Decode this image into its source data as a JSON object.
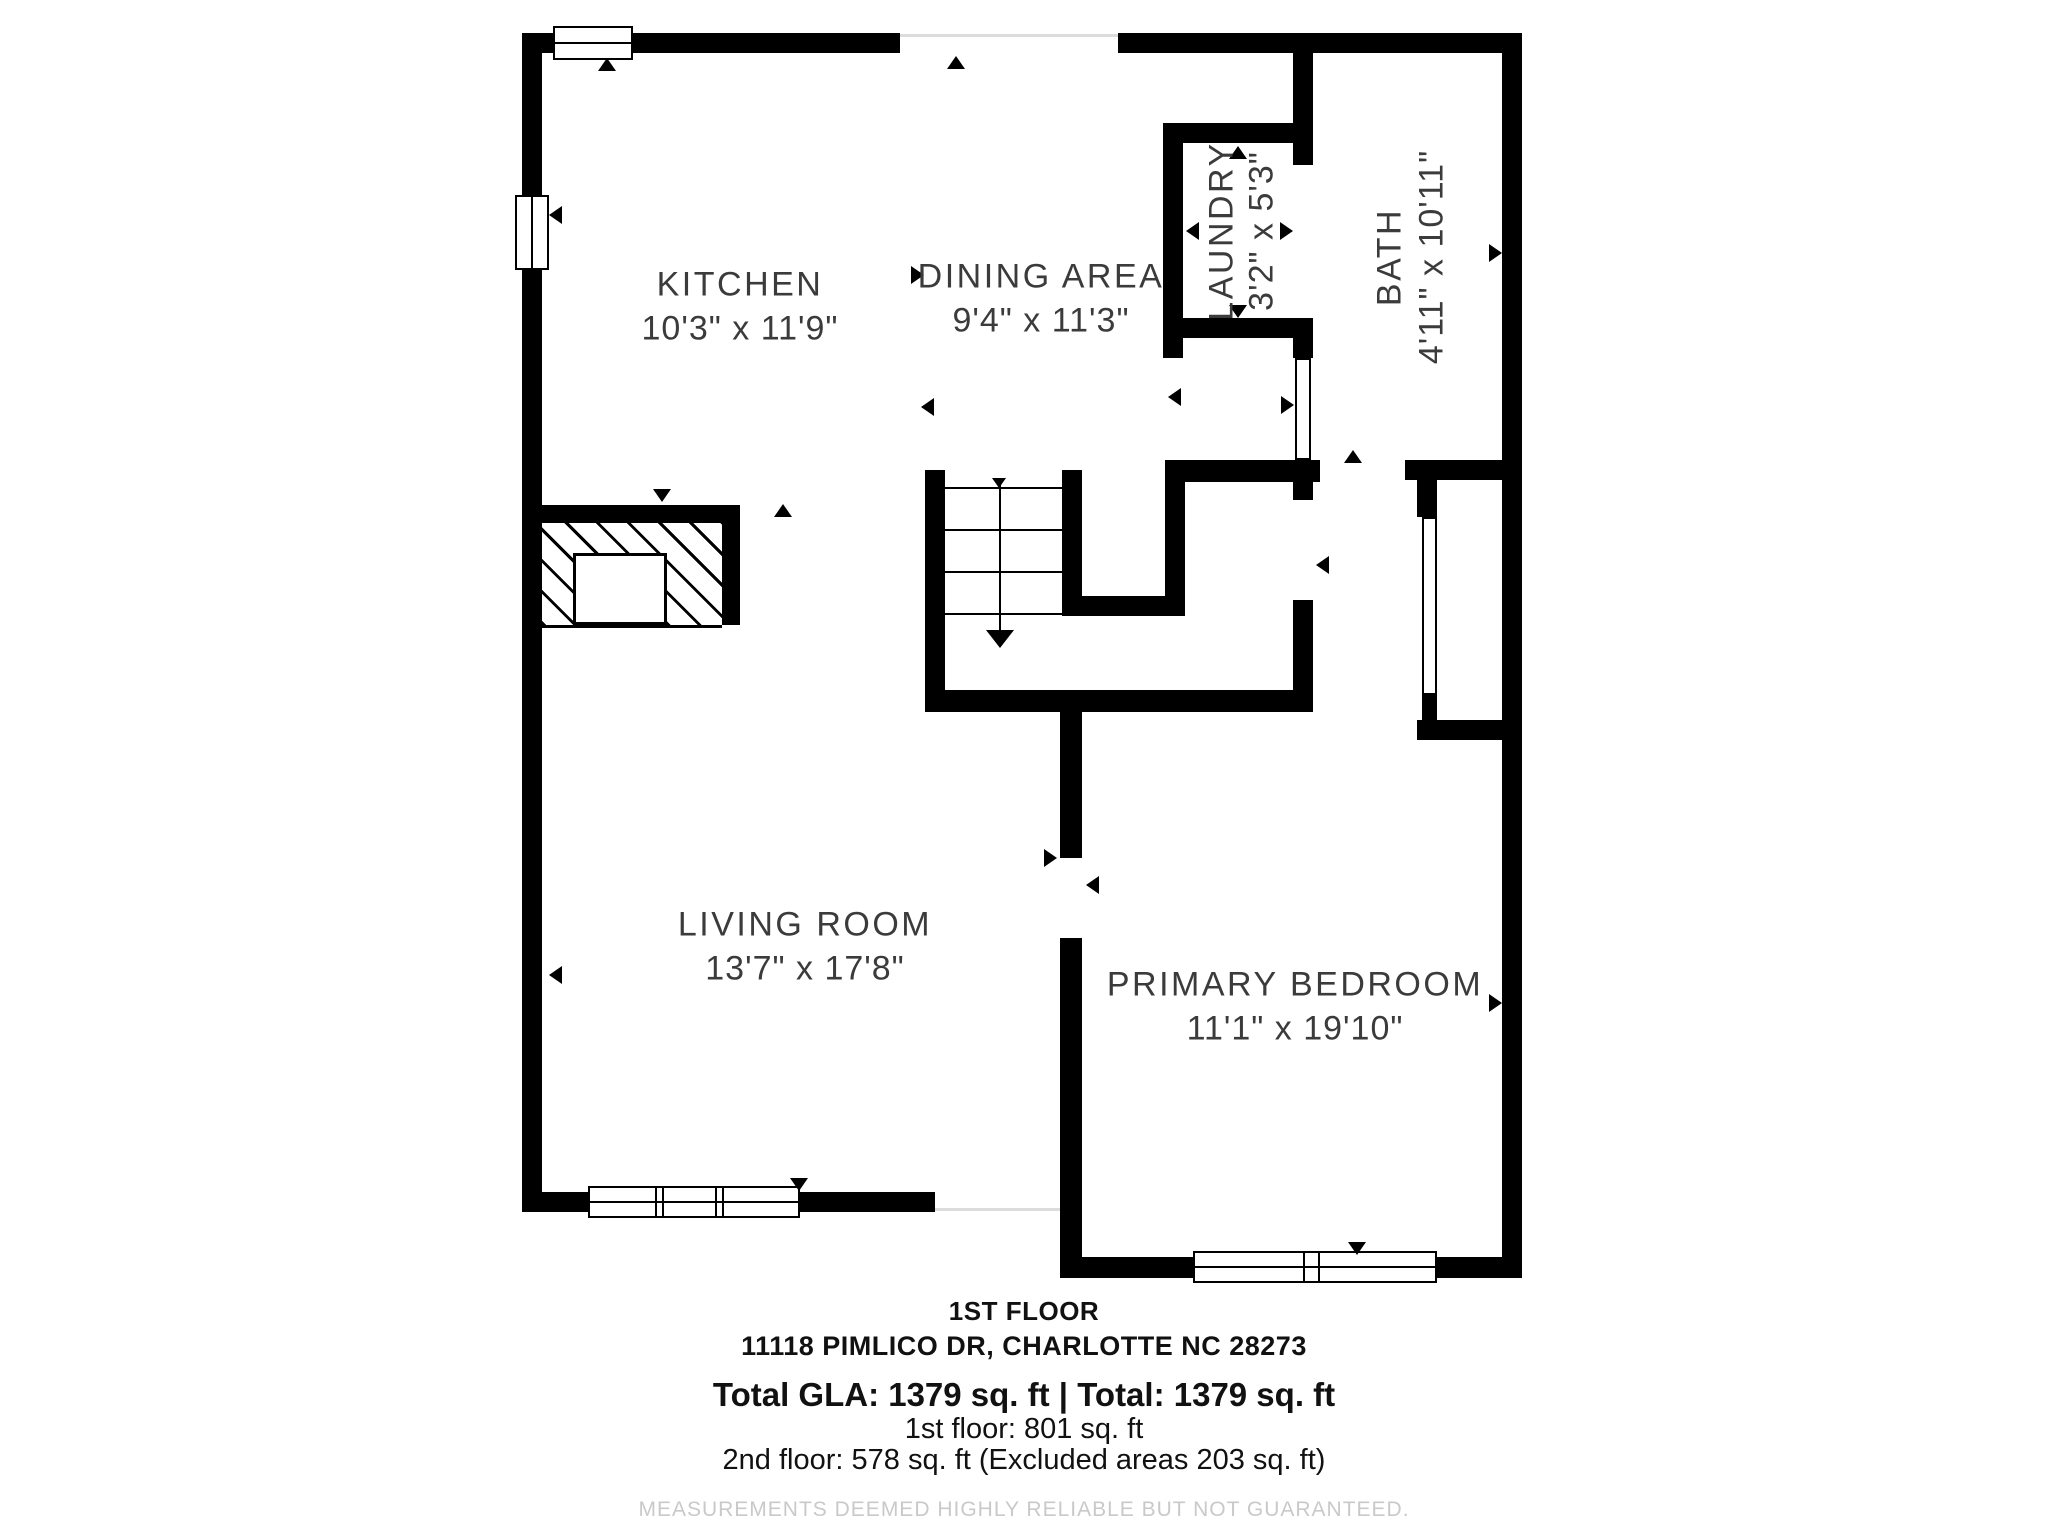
{
  "floorplan": {
    "rooms": {
      "kitchen": {
        "name": "KITCHEN",
        "dims": "10'3\" x 11'9\""
      },
      "dining": {
        "name": "DINING AREA",
        "dims": "9'4\" x 11'3\""
      },
      "laundry": {
        "name": "LAUNDRY",
        "dims": "3'2\" x 5'3\""
      },
      "bath": {
        "name": "BATH",
        "dims": "4'11\" x 10'11\""
      },
      "living": {
        "name": "LIVING ROOM",
        "dims": "13'7\" x 17'8\""
      },
      "bedroom": {
        "name": "PRIMARY BEDROOM",
        "dims": "11'1\" x 19'10\""
      }
    },
    "colors": {
      "wall": "#000000",
      "label": "#3b3b3b",
      "disclaimer": "#c9c9c9"
    }
  },
  "footer": {
    "floor_label": "1ST FLOOR",
    "address": "11118 PIMLICO DR, CHARLOTTE NC 28273",
    "total_line": "Total GLA: 1379 sq. ft | Total: 1379 sq. ft",
    "first_floor_line": "1st floor: 801 sq. ft",
    "second_floor_line": "2nd floor: 578 sq. ft (Excluded areas 203 sq. ft)",
    "disclaimer": "MEASUREMENTS DEEMED HIGHLY RELIABLE BUT NOT GUARANTEED."
  }
}
